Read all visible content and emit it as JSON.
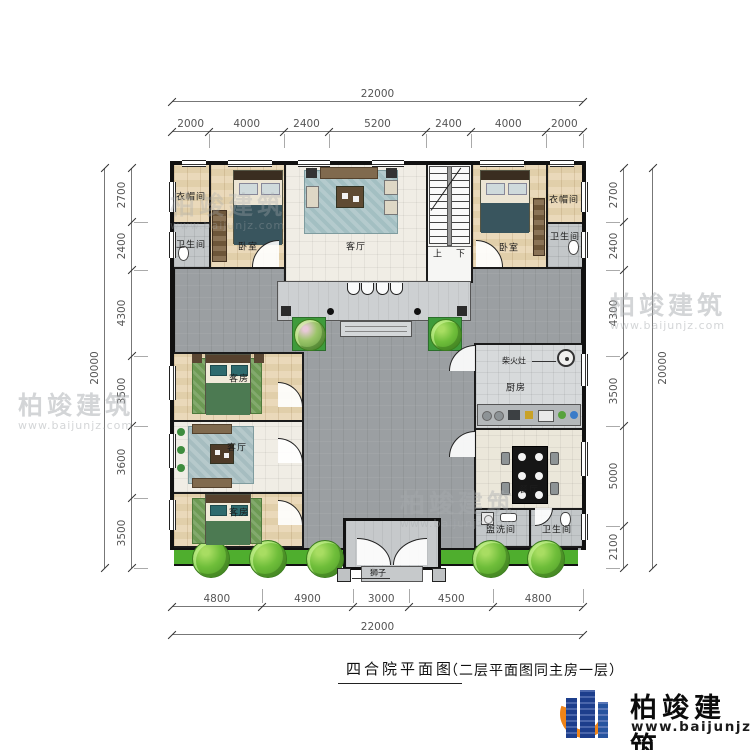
{
  "title": {
    "main": "四合院平面图",
    "note": "（二层平面图同主房一层）"
  },
  "brand": {
    "name": "柏竣建筑",
    "url": "www.baijunjz.com",
    "blue": "#1d3e8c",
    "orange": "#ef8418"
  },
  "dims": {
    "top": {
      "total": "22000",
      "segments": [
        "2000",
        "4000",
        "2400",
        "5200",
        "2400",
        "4000",
        "2000"
      ]
    },
    "bottom": {
      "total": "22000",
      "segments": [
        "4800",
        "4900",
        "3000",
        "4500",
        "4800"
      ]
    },
    "left": {
      "total": "20000",
      "segments": [
        "2700",
        "2400",
        "4300",
        "3500",
        "3600",
        "3500"
      ]
    },
    "right": {
      "total": "20000",
      "segments": [
        "2700",
        "2400",
        "4300",
        "3500",
        "5000",
        "2100"
      ]
    }
  },
  "rooms": [
    {
      "id": "cloakroom-left",
      "label": "衣帽间",
      "x": 191,
      "y": 196
    },
    {
      "id": "bathroom-left",
      "label": "卫生间",
      "x": 191,
      "y": 244
    },
    {
      "id": "bedroom-left",
      "label": "卧室",
      "x": 248,
      "y": 246
    },
    {
      "id": "living-north",
      "label": "客厅",
      "x": 356,
      "y": 246
    },
    {
      "id": "stairs-up",
      "label": "上",
      "x": 438,
      "y": 253
    },
    {
      "id": "stairs-down",
      "label": "下",
      "x": 461,
      "y": 253
    },
    {
      "id": "bedroom-right",
      "label": "卧室",
      "x": 509,
      "y": 247
    },
    {
      "id": "cloakroom-right",
      "label": "衣帽间",
      "x": 564,
      "y": 199
    },
    {
      "id": "bathroom-right",
      "label": "卫生间",
      "x": 565,
      "y": 236
    },
    {
      "id": "guestroom-1",
      "label": "客房",
      "x": 239,
      "y": 378
    },
    {
      "id": "living-west",
      "label": "客厅",
      "x": 237,
      "y": 447
    },
    {
      "id": "guestroom-2",
      "label": "客房",
      "x": 239,
      "y": 512
    },
    {
      "id": "kitchen",
      "label": "厨房",
      "x": 516,
      "y": 387
    },
    {
      "id": "dining",
      "label": "餐厅",
      "x": 529,
      "y": 489
    },
    {
      "id": "washroom",
      "label": "盥洗间",
      "x": 501,
      "y": 529
    },
    {
      "id": "bathroom-south",
      "label": "卫生间",
      "x": 557,
      "y": 529
    }
  ],
  "annotations": [
    {
      "id": "wood-stove",
      "label": "柴火灶",
      "x": 514,
      "y": 361
    },
    {
      "id": "stone-lion",
      "label": "狮子",
      "x": 378,
      "y": 573
    }
  ]
}
